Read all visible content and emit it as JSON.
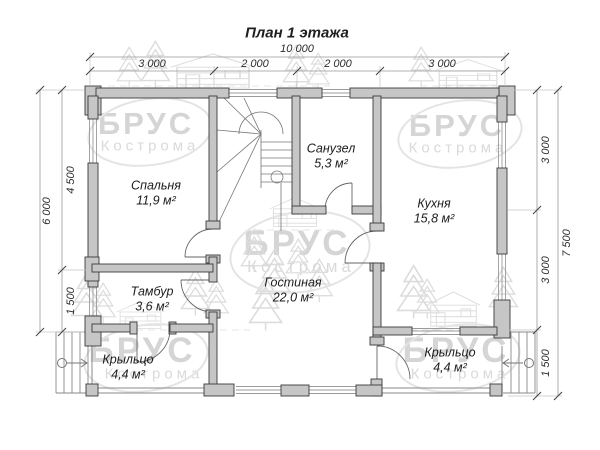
{
  "title": "План 1 этажа",
  "watermark": {
    "brand": "БРУС",
    "city": "Кострома"
  },
  "dimensions": {
    "top": {
      "total": "10 000",
      "segments": [
        "3 000",
        "2 000",
        "2 000",
        "3 000"
      ]
    },
    "left": {
      "total": "6 000",
      "segments": [
        "4 500",
        "1 500"
      ]
    },
    "right": {
      "total": "7 500",
      "segments": [
        "3 000",
        "3 000",
        "1 500"
      ]
    }
  },
  "rooms": [
    {
      "name": "Спальня",
      "area": "11,9 м²"
    },
    {
      "name": "Санузел",
      "area": "5,3 м²"
    },
    {
      "name": "Кухня",
      "area": "15,8 м²"
    },
    {
      "name": "Тамбур",
      "area": "3,6 м²"
    },
    {
      "name": "Гостиная",
      "area": "22,0 м²"
    },
    {
      "name": "Крыльцо",
      "area": "4,4 м²"
    },
    {
      "name": "Крыльцо",
      "area": "4,4 м²"
    }
  ],
  "colors": {
    "wall_fill": "#c6c6c6",
    "wall_outline": "#3a3a3a",
    "thin_line": "#8a8a8a",
    "dimension_line": "#999999",
    "text": "#1c1c1c",
    "watermark": "#d5d5d5"
  }
}
